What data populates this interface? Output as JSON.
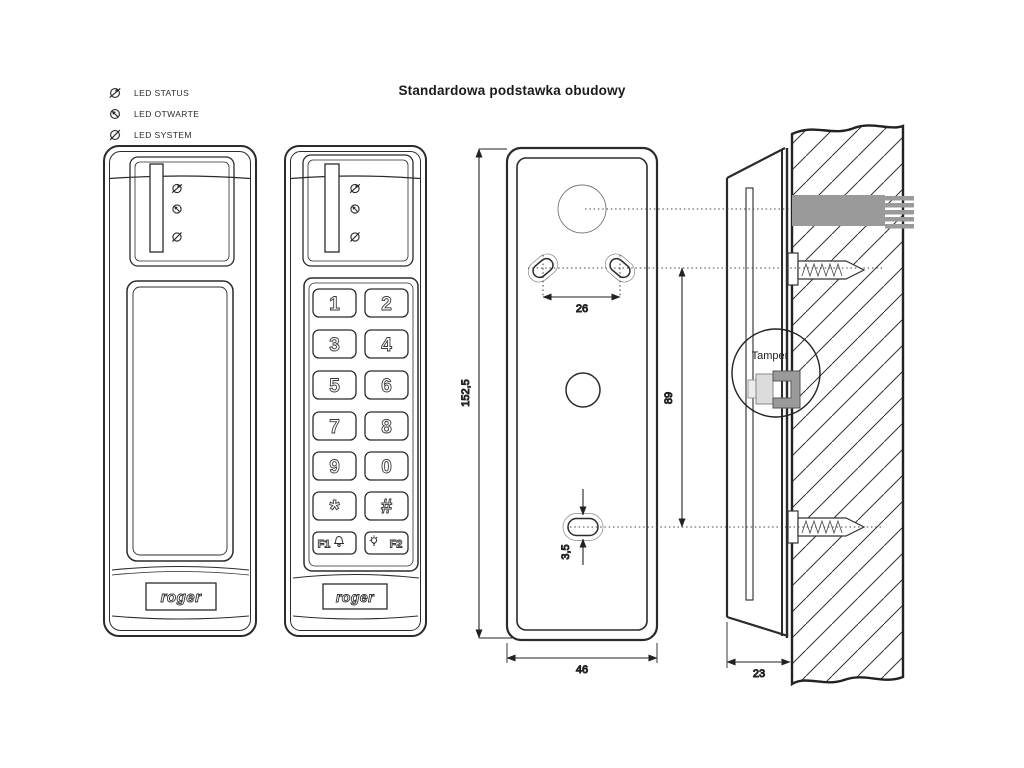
{
  "title": "Standardowa podstawka obudowy",
  "legend": {
    "items": [
      {
        "icon": "led-status-icon",
        "label": "LED STATUS"
      },
      {
        "icon": "led-otwarte-icon",
        "label": "LED OTWARTE"
      },
      {
        "icon": "led-system-icon",
        "label": "LED SYSTEM"
      }
    ]
  },
  "devices": {
    "brand": "roger",
    "keypad": {
      "keys": [
        "1",
        "2",
        "3",
        "4",
        "5",
        "6",
        "7",
        "8",
        "9",
        "0",
        "*",
        "#"
      ],
      "f1": "F1",
      "f2": "F2"
    }
  },
  "dimensions": {
    "height": "152,5",
    "width": "46",
    "holes_horizontal": "26",
    "holes_vertical": "89",
    "slot": "3,5",
    "depth": "23"
  },
  "annotations": {
    "tamper": "Tamper"
  },
  "colors": {
    "line": "#2b2b2b",
    "cable": "#9a9a9a",
    "background": "#ffffff"
  }
}
